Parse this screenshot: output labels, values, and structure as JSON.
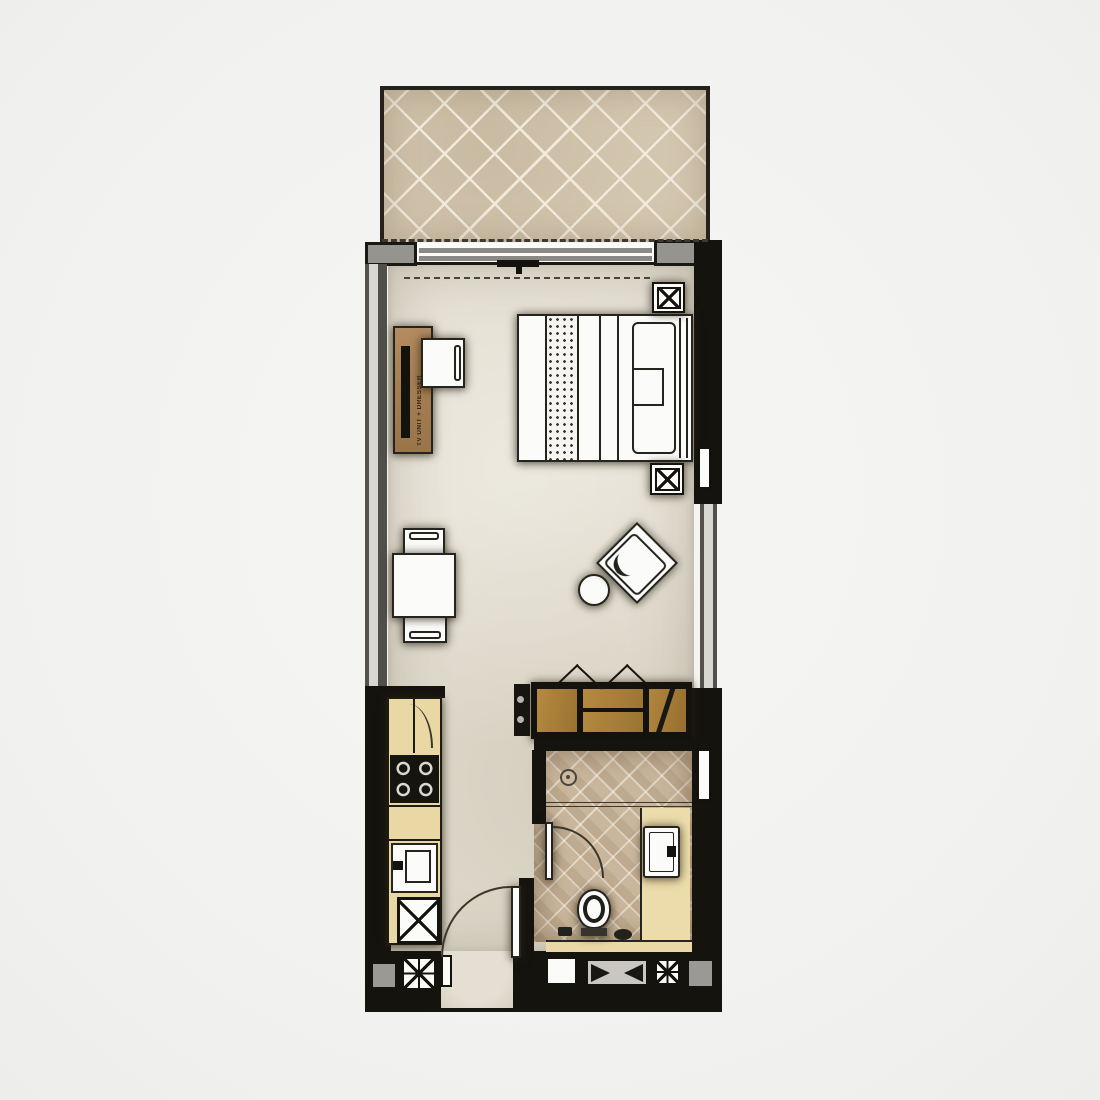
{
  "plan_type": "studio-apartment-floor-plan",
  "labels": {
    "desk": "TV UNIT + DRESSER"
  },
  "colors": {
    "page_background": "#f3f3f1",
    "floor": "#e2ddd0",
    "balcony_tile": "#d3c6af",
    "bathroom_tile": "#c9b69c",
    "wall_black": "#15130e",
    "wall_gray": "#96948f",
    "wood_desk": "#a87f55",
    "wood_wardrobe": "#ab7f3e",
    "kitchen_counter": "#e9d8a3",
    "vanity_counter": "#ecdcab",
    "fixture_white": "#fbfbf9"
  },
  "rooms": [
    {
      "name": "balcony",
      "finish": "diagonal-tile"
    },
    {
      "name": "bedroom-living",
      "finish": "plain-floor"
    },
    {
      "name": "kitchenette",
      "finish": "plain-floor"
    },
    {
      "name": "bathroom",
      "finish": "diamond-tile"
    }
  ],
  "furniture": [
    {
      "name": "double-bed",
      "room": "bedroom-living"
    },
    {
      "name": "nightstand",
      "count": 2,
      "room": "bedroom-living"
    },
    {
      "name": "tv-unit-dresser-desk",
      "room": "bedroom-living"
    },
    {
      "name": "desk-chair",
      "room": "bedroom-living"
    },
    {
      "name": "dining-table",
      "room": "bedroom-living"
    },
    {
      "name": "dining-chair",
      "count": 2,
      "room": "bedroom-living"
    },
    {
      "name": "armchair",
      "room": "bedroom-living"
    },
    {
      "name": "round-side-table",
      "room": "bedroom-living"
    },
    {
      "name": "wardrobe-3-door",
      "room": "bedroom-living"
    }
  ],
  "fixtures": [
    {
      "name": "kitchen-counter",
      "room": "kitchenette"
    },
    {
      "name": "cooktop-4-burner",
      "room": "kitchenette"
    },
    {
      "name": "kitchen-sink",
      "room": "kitchenette"
    },
    {
      "name": "appliance-cross-box",
      "room": "kitchenette"
    },
    {
      "name": "shower-with-drain",
      "room": "bathroom"
    },
    {
      "name": "vanity-sink",
      "room": "bathroom"
    },
    {
      "name": "toilet",
      "room": "bathroom"
    }
  ],
  "doors_windows": [
    {
      "name": "balcony-sliding-door",
      "wall": "top"
    },
    {
      "name": "entry-door-swing",
      "wall": "bottom"
    },
    {
      "name": "bathroom-door-swing",
      "wall": "bathroom-left"
    },
    {
      "name": "window-niche",
      "wall": "right",
      "count": 2
    }
  ],
  "wall_symbols": [
    {
      "name": "column-cross-symbol",
      "count": 2
    },
    {
      "name": "shaft-bowtie-symbol",
      "count": 1
    },
    {
      "name": "gray-block-symbol",
      "count": 2
    },
    {
      "name": "white-niche-symbol",
      "count": 1
    }
  ]
}
